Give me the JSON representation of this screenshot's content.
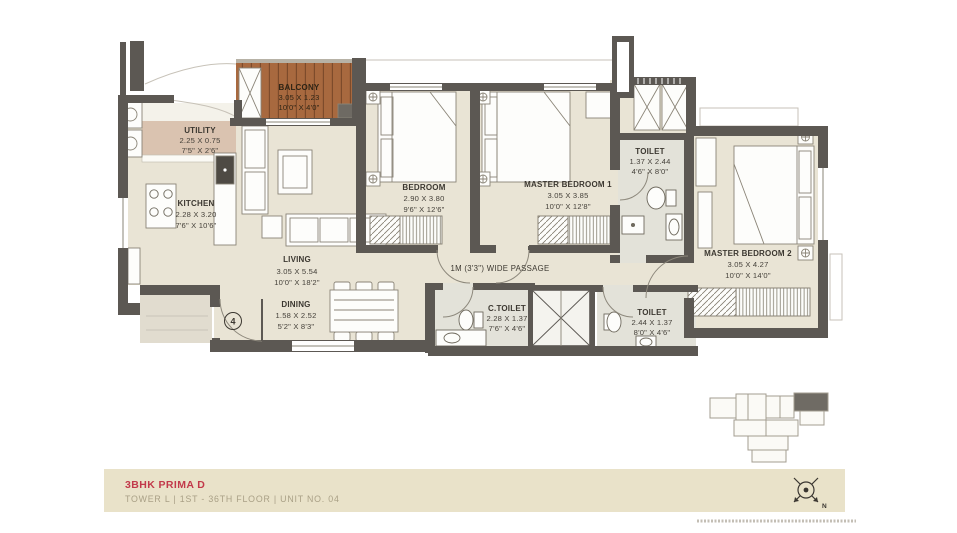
{
  "colors": {
    "wall": "#5c5853",
    "floor": "#e9e4d5",
    "wet_floor": "#e3e2d9",
    "balcony_wood": "#a8693f",
    "utility_pink": "#dac3b0",
    "accent_red": "#c2394a",
    "footer_bar": "#e9e2c9",
    "footer_subtitle": "#a9a086"
  },
  "plan": {
    "entry_number": "4",
    "passage_label": "1M (3'3\") WIDE PASSAGE",
    "rooms": [
      {
        "id": "balcony",
        "name": "BALCONY",
        "metric": "3.05 X 1.23",
        "imperial": "10'0\" X 4'0\""
      },
      {
        "id": "utility",
        "name": "UTILITY",
        "metric": "2.25 X 0.75",
        "imperial": "7'5\" X 2'6\""
      },
      {
        "id": "kitchen",
        "name": "KITCHEN",
        "metric": "2.28 X 3.20",
        "imperial": "7'6\" X 10'6\""
      },
      {
        "id": "living",
        "name": "LIVING",
        "metric": "3.05 X 5.54",
        "imperial": "10'0\" X 18'2\""
      },
      {
        "id": "dining",
        "name": "DINING",
        "metric": "1.58 X 2.52",
        "imperial": "5'2\" X 8'3\""
      },
      {
        "id": "bedroom",
        "name": "BEDROOM",
        "metric": "2.90 X 3.80",
        "imperial": "9'6\" X 12'6\""
      },
      {
        "id": "master-bedroom-1",
        "name": "MASTER BEDROOM 1",
        "metric": "3.05 X 3.85",
        "imperial": "10'0\" X 12'8\""
      },
      {
        "id": "toilet-upper",
        "name": "TOILET",
        "metric": "1.37 X 2.44",
        "imperial": "4'6\" X 8'0\""
      },
      {
        "id": "master-bedroom-2",
        "name": "MASTER BEDROOM 2",
        "metric": "3.05 X 4.27",
        "imperial": "10'0\" X 14'0\""
      },
      {
        "id": "c-toilet",
        "name": "C.TOILET",
        "metric": "2.28 X 1.37",
        "imperial": "7'6\" X 4'6\""
      },
      {
        "id": "toilet-lower",
        "name": "TOILET",
        "metric": "2.44 X 1.37",
        "imperial": "8'0\" X 4'6\""
      }
    ]
  },
  "footer": {
    "title": "3BHK PRIMA D",
    "subtitle": "TOWER L  |  1ST - 36TH FLOOR  |  UNIT NO. 04",
    "compass_label": "N"
  }
}
